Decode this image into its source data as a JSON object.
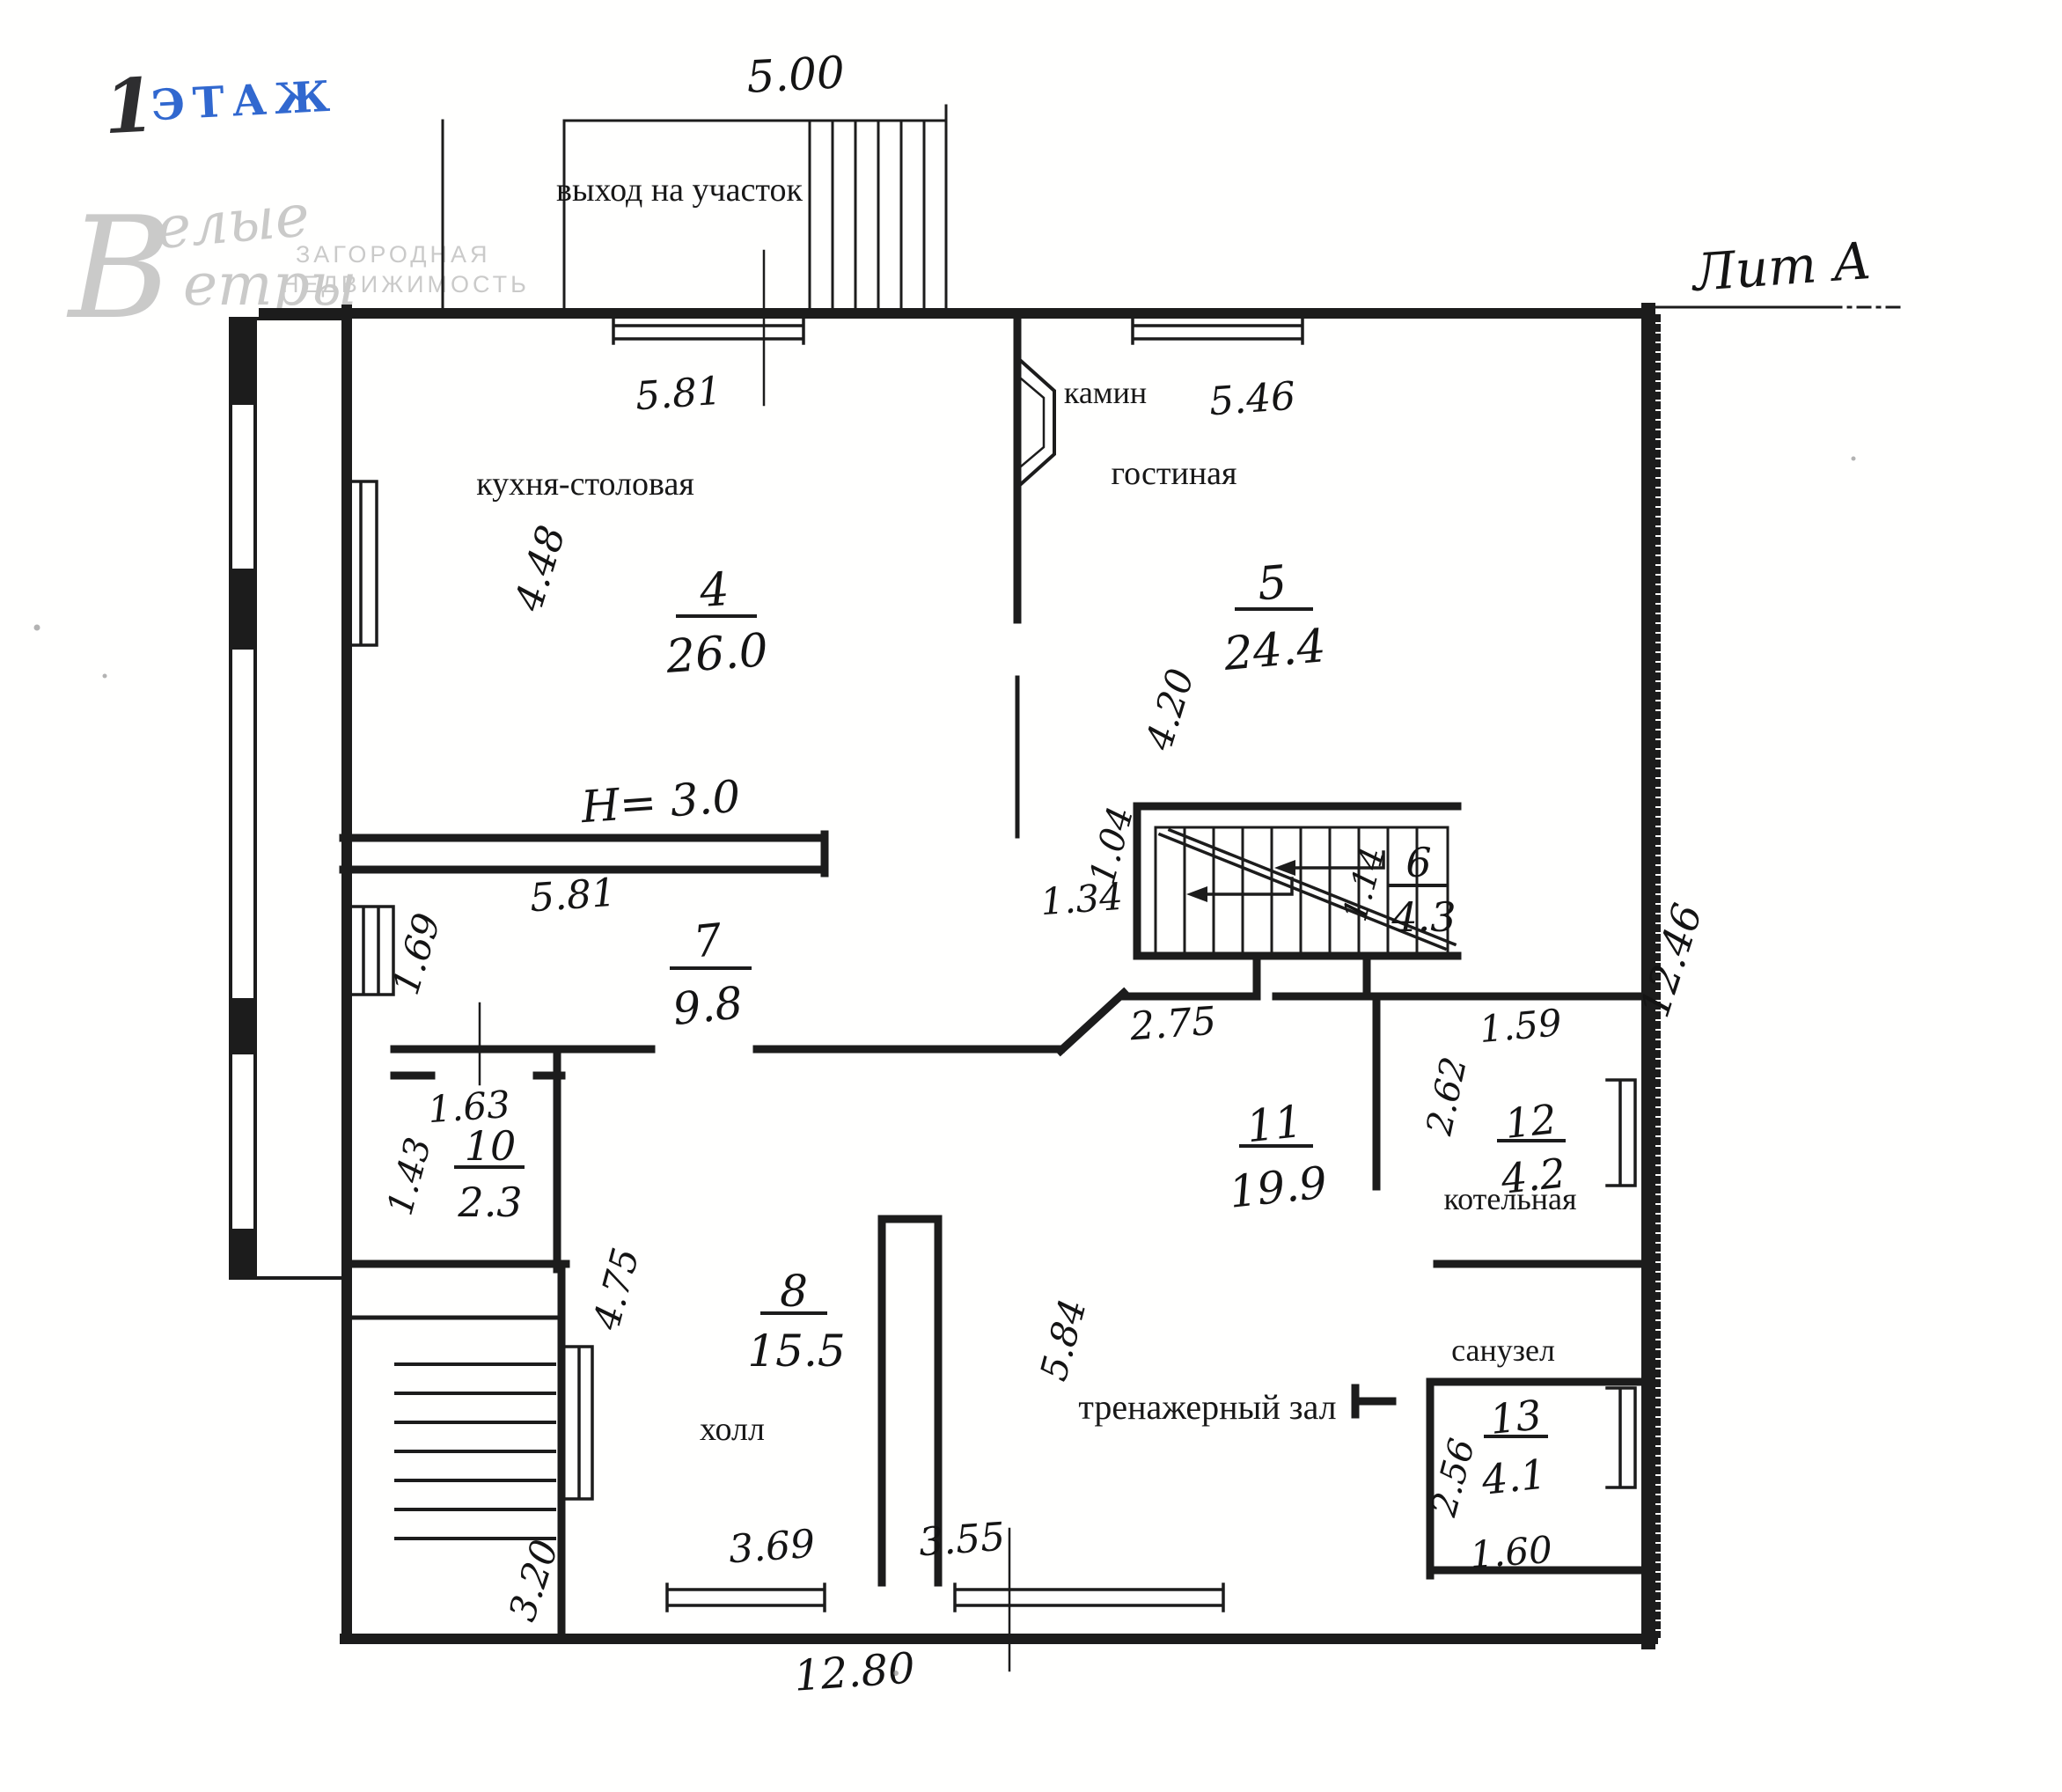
{
  "stamp": {
    "number": "1",
    "word": "ЭТАЖ"
  },
  "litera": "Лит А",
  "watermark": {
    "script_big": "В",
    "script_top": "елые",
    "script_bottom": "етры",
    "sub1": "ЗАГОРОДНАЯ",
    "sub2": "НЕДВИЖИМОСТЬ"
  },
  "exit_label": "выход на участок",
  "ceiling": "H= 3.0",
  "rooms": {
    "kitchen": {
      "name": "кухня-столовая",
      "number": "4",
      "area": "26.0"
    },
    "living": {
      "name": "гостиная",
      "number": "5",
      "area": "24.4"
    },
    "fireplace": "камин",
    "stair_room": {
      "number": "6",
      "area": "4.3"
    },
    "corridor": {
      "number": "7",
      "area": "9.8"
    },
    "hall": {
      "name": "холл",
      "number": "8",
      "area": "15.5"
    },
    "pantry": {
      "number": "10",
      "area": "2.3"
    },
    "gym": {
      "name": "тренажерный зал",
      "number": "11",
      "area": "19.9"
    },
    "boiler": {
      "name": "котельная",
      "number": "12",
      "area": "4.2"
    },
    "bath": {
      "name": "санузел",
      "number": "13",
      "area": "4.1"
    }
  },
  "dims": {
    "porch_width": "5.00",
    "kitchen_top": "5.81",
    "kitchen_left": "4.48",
    "living_top": "5.46",
    "living_left": "4.20",
    "stair_left": "1.04",
    "stair_under": "1.34",
    "stair_right": "1.14",
    "corridor_top": "5.81",
    "corridor_left": "1.69",
    "passage": "2.75",
    "boiler_top": "1.59",
    "boiler_left": "2.62",
    "pantry_top": "1.63",
    "pantry_left": "1.43",
    "hall_left": "4.75",
    "hall_bottom": "3.69",
    "gym_left": "5.84",
    "gym_bottom": "3.55",
    "bath_left": "2.56",
    "bath_bottom": "1.60",
    "porch_side": "3.20",
    "total_bottom": "12.80",
    "total_right": "12.46"
  }
}
